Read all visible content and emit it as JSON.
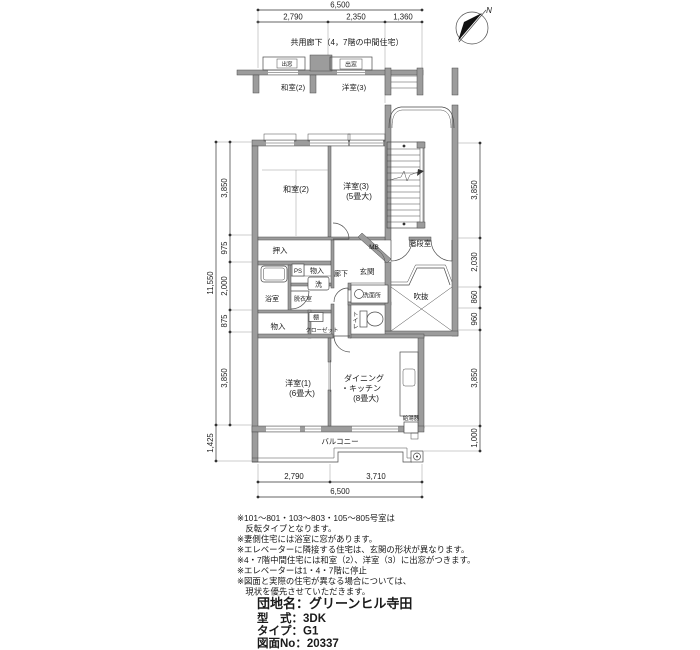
{
  "compass": {
    "north_label": "N"
  },
  "header": {
    "corridor_note": "共用廊下（4，7階の中間住宅）"
  },
  "upper_section": {
    "bay_left": "出窓",
    "bay_right": "出窓",
    "room_left": "和室(2)",
    "room_right": "洋室(3)"
  },
  "dims": {
    "top_total": "6,500",
    "top_segs": [
      "2,790",
      "2,350",
      "1,360"
    ],
    "left_total": "11,550",
    "left_segs": [
      "3,850",
      "975",
      "2,000",
      "875",
      "3,850"
    ],
    "left_balcony": "1,425",
    "right_segs": [
      "3,850",
      "2,030",
      "860",
      "960",
      "3,850",
      "1,000"
    ],
    "bottom_segs": [
      "2,790",
      "3,710"
    ],
    "bottom_total": "6,500"
  },
  "rooms": {
    "washitsu2": "和室(2)",
    "youshitsu3": "洋室(3)",
    "youshitsu3_size": "(5畳大)",
    "oshiire": "押入",
    "mb": "MB",
    "kaidanshitsu": "階段室",
    "genkan": "玄関",
    "rouka": "廊下",
    "ps": "PS",
    "monoire_upper": "物入",
    "sentaku": "洗",
    "yokushitsu": "浴室",
    "datsuishitsu": "脱衣室",
    "senmenjo": "洗面所",
    "toire": "トイレ",
    "fukinuke": "吹抜",
    "monoire_lower": "物入",
    "tana": "棚",
    "closet": "クローゼット",
    "youshitsu1": "洋室(1)",
    "youshitsu1_size": "(6畳大)",
    "dining_line1": "ダイニング",
    "dining_line2": "・キッチン",
    "dining_size": "(8畳大)",
    "kyutouki": "給湯器",
    "balcony": "バルコニー"
  },
  "notes": [
    "※101～801・103～803・105～805号室は",
    "　反転タイプとなります。",
    "※妻側住宅には浴室に窓があります。",
    "※エレベーターに隣接する住宅は、玄関の形状が異なります。",
    "※4・7階中間住宅には和室（2）、洋室（3）に出窓がつきます。",
    "※エレベーターは1・4・7階に停止",
    "※図面と実際の住宅が異なる場合については、",
    "　現状を優先させていただきます。"
  ],
  "title_block": {
    "estate": "団地名：グリーンヒル寺田",
    "layout": "型　式：3DK",
    "type": "タイプ：G1",
    "drawing_no": "図面No：20337"
  }
}
